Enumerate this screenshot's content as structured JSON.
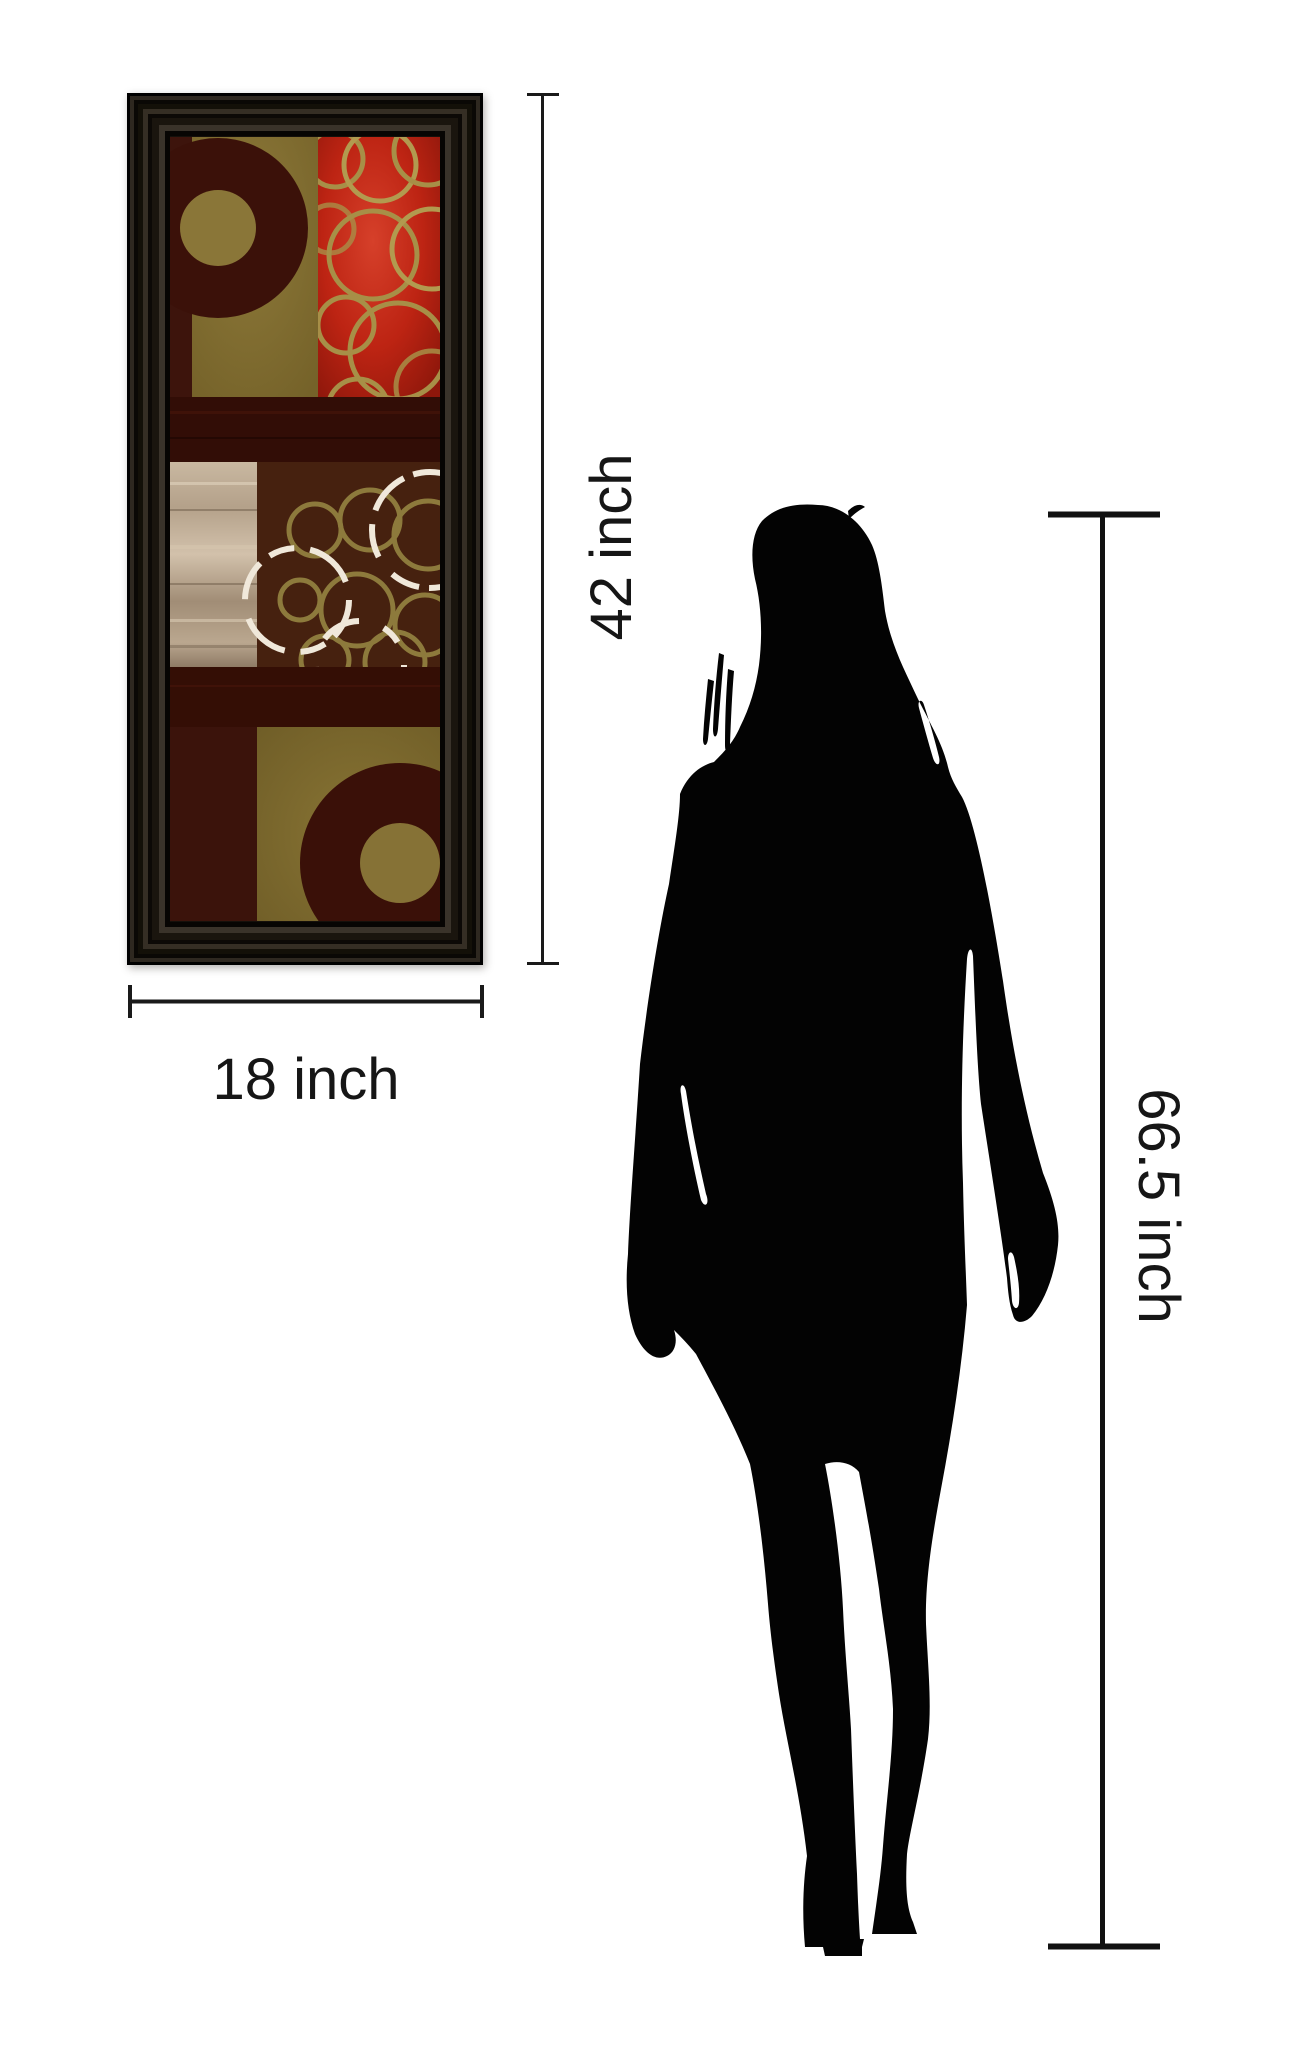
{
  "diagram": {
    "type": "product-size-comparison",
    "background": "#ffffff"
  },
  "labels": {
    "art_height": "42 inch",
    "art_width": "18 inch",
    "person_height": "66.5 inch"
  },
  "measure": {
    "line_color": "#1a1a1a",
    "text_color": "#161616"
  },
  "artwork": {
    "description": "framed abstract circles wall-art print",
    "frame_color": "#15100b",
    "colors": {
      "olive": "#867236",
      "red": "#c22a17",
      "maroon": "#3a1109",
      "brown": "#46210f",
      "tan": "#b9a68f",
      "gold_rings": "#a78f47",
      "cream_rings": "#f0e8da"
    }
  },
  "silhouette": {
    "subject": "standing woman silhouette",
    "color": "#030303"
  }
}
